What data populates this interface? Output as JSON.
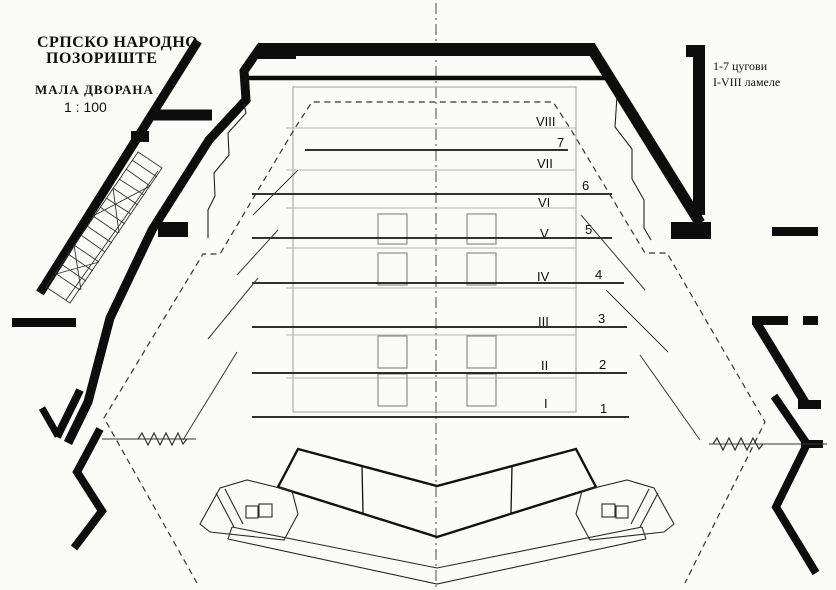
{
  "document": {
    "title_line1": "СРПСКО НАРОДНО",
    "title_line2": "ПОЗОРИШТЕ",
    "hall_name": "МАЛА ДВОРАНА",
    "scale": "1 : 100"
  },
  "legend": {
    "cugovi": "1-7 цугови",
    "lamele": "I-VIII ламеле"
  },
  "stage": {
    "lamele_labels": [
      "VIII",
      "VII",
      "VI",
      "V",
      "IV",
      "III",
      "II",
      "I"
    ],
    "cug_labels": [
      "7",
      "6",
      "5",
      "4",
      "3",
      "2",
      "1"
    ]
  },
  "colors": {
    "ink": "#0d0d0d",
    "line_dark": "#141414",
    "line_gray": "#b0b0b0",
    "paper": "#fbfbf8"
  }
}
